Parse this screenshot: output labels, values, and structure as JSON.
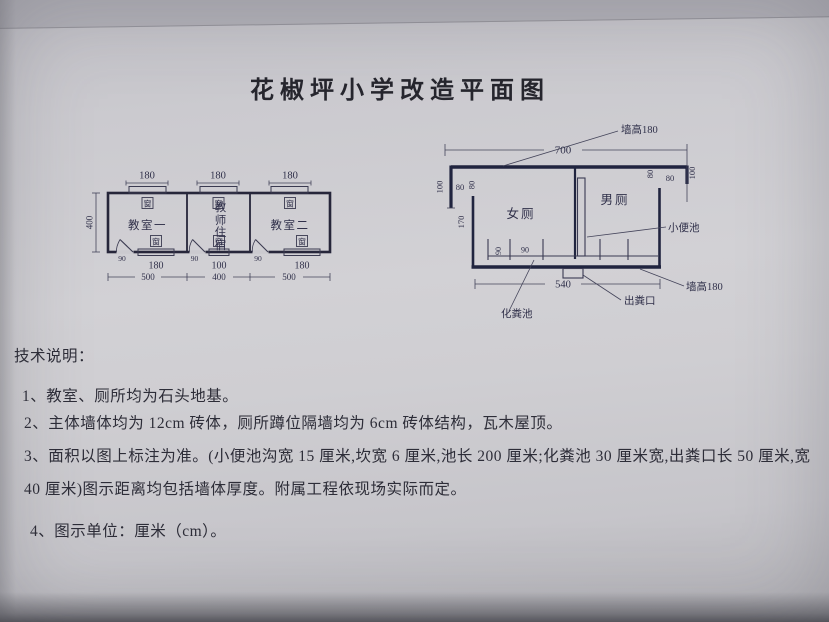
{
  "title": "花椒坪小学改造平面图",
  "colors": {
    "paper": "#cbcacf",
    "ink": "#30304a",
    "wall_ink": "#20243f"
  },
  "classroom_plan": {
    "top_dims": [
      "180",
      "180",
      "180"
    ],
    "left_dim": "400",
    "rooms": [
      "教室一",
      "教师住宿",
      "教室二"
    ],
    "window_char": "窗",
    "door_widths": [
      "90",
      "90",
      "90"
    ],
    "opening_dims": [
      "180",
      "100",
      "180"
    ],
    "room_widths": [
      "500",
      "400",
      "500"
    ]
  },
  "toilet_plan": {
    "top_total": "700",
    "bottom_total": "540",
    "wall_height_top": "墙高180",
    "wall_height_bottom": "墙高180",
    "left_outer": "100",
    "left_open_a": "80",
    "left_open_b": "80",
    "left_wall": "170",
    "right_open_a": "80",
    "right_open_b": "80",
    "right_outer": "100",
    "stall_a": "90",
    "stall_b": "90",
    "room_left": "女厕",
    "room_right": "男厕",
    "urinal_label": "小便池",
    "septic_label": "化粪池",
    "outlet_label": "出粪口"
  },
  "notes": {
    "heading": "技术说明：",
    "items": [
      "1、教室、厕所均为石头地基。",
      "2、主体墙体均为 12cm 砖体，厕所蹲位隔墙均为 6cm 砖体结构，瓦木屋顶。",
      "3、面积以图上标注为准。(小便池沟宽 15 厘米,坎宽 6 厘米,池长 200 厘米;化粪池 30 厘米宽,出粪口长 50 厘米,宽 40 厘米)图示距离均包括墙体厚度。附属工程依现场实际而定。",
      "4、图示单位：厘米（cm）。"
    ]
  }
}
